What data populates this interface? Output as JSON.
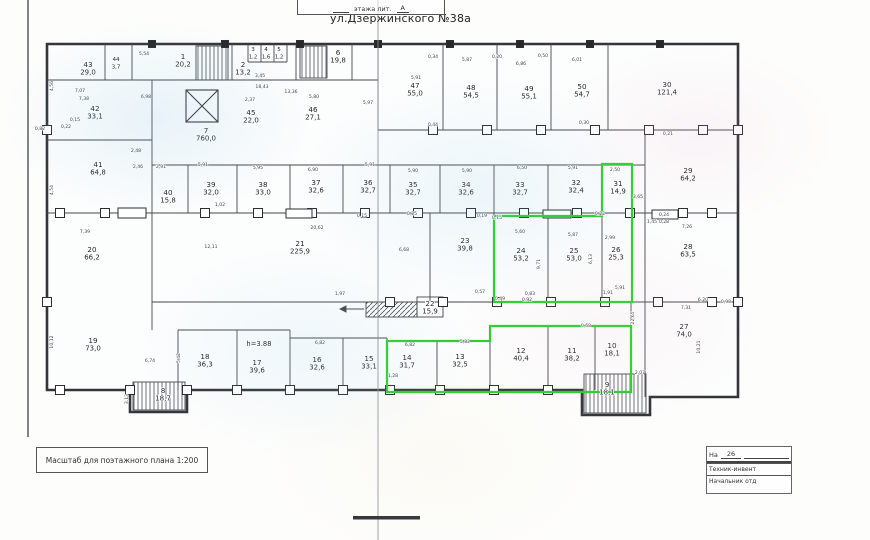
{
  "title": "ул.Дзержинского №38а",
  "stamp_top": {
    "text": "этажа лит.",
    "litera": "А"
  },
  "scale_note": "Масштаб для поэтажного плана 1:200",
  "stamp_bottom": {
    "na_label": "На",
    "na_value": "26",
    "row1": "Техник-инвент",
    "row2": "Начальник отд"
  },
  "colors": {
    "highlight": "#2ccf2c",
    "ink": "#23252a",
    "wall": "#33353a"
  },
  "plan": {
    "highlighted_rooms": [
      "10",
      "11",
      "12",
      "13",
      "14",
      "24",
      "25",
      "26",
      "31"
    ],
    "rooms": [
      {
        "n": "1",
        "a": "20,2",
        "x": 183,
        "y": 60
      },
      {
        "n": "2",
        "a": "13,2",
        "x": 243,
        "y": 68
      },
      {
        "n": "3",
        "a": "1,2",
        "x": 253,
        "y": 52,
        "s": 1
      },
      {
        "n": "4",
        "a": "1,6",
        "x": 266,
        "y": 52,
        "s": 1
      },
      {
        "n": "5",
        "a": "1,2",
        "x": 279,
        "y": 52,
        "s": 1
      },
      {
        "n": "6",
        "a": "19,8",
        "x": 338,
        "y": 56
      },
      {
        "n": "7",
        "a": "760,0",
        "x": 206,
        "y": 134
      },
      {
        "n": "8",
        "a": "18,7",
        "x": 163,
        "y": 394
      },
      {
        "n": "9",
        "a": "18,1",
        "x": 607,
        "y": 388
      },
      {
        "n": "10",
        "a": "18,1",
        "x": 612,
        "y": 349,
        "g": 1
      },
      {
        "n": "11",
        "a": "38,2",
        "x": 572,
        "y": 354,
        "g": 1
      },
      {
        "n": "12",
        "a": "40,4",
        "x": 521,
        "y": 354,
        "g": 1
      },
      {
        "n": "13",
        "a": "32,5",
        "x": 460,
        "y": 360,
        "g": 1
      },
      {
        "n": "14",
        "a": "31,7",
        "x": 407,
        "y": 361,
        "g": 1
      },
      {
        "n": "15",
        "a": "33,1",
        "x": 369,
        "y": 362
      },
      {
        "n": "16",
        "a": "32,6",
        "x": 317,
        "y": 363
      },
      {
        "n": "17",
        "a": "39,6",
        "x": 257,
        "y": 366
      },
      {
        "n": "18",
        "a": "36,3",
        "x": 205,
        "y": 360
      },
      {
        "n": "19",
        "a": "73,0",
        "x": 93,
        "y": 344
      },
      {
        "n": "20",
        "a": "66,2",
        "x": 92,
        "y": 253
      },
      {
        "n": "21",
        "a": "225,9",
        "x": 300,
        "y": 247
      },
      {
        "n": "22",
        "a": "15,9",
        "x": 430,
        "y": 307
      },
      {
        "n": "23",
        "a": "39,8",
        "x": 465,
        "y": 244
      },
      {
        "n": "24",
        "a": "53,2",
        "x": 521,
        "y": 254,
        "g": 1
      },
      {
        "n": "25",
        "a": "53,0",
        "x": 574,
        "y": 254,
        "g": 1
      },
      {
        "n": "26",
        "a": "25,3",
        "x": 616,
        "y": 253,
        "g": 1
      },
      {
        "n": "27",
        "a": "74,0",
        "x": 684,
        "y": 330
      },
      {
        "n": "28",
        "a": "63,5",
        "x": 688,
        "y": 250
      },
      {
        "n": "29",
        "a": "64,2",
        "x": 688,
        "y": 174
      },
      {
        "n": "30",
        "a": "121,4",
        "x": 667,
        "y": 88
      },
      {
        "n": "31",
        "a": "14,9",
        "x": 618,
        "y": 187,
        "g": 1
      },
      {
        "n": "32",
        "a": "32,4",
        "x": 576,
        "y": 186
      },
      {
        "n": "33",
        "a": "32,7",
        "x": 520,
        "y": 188
      },
      {
        "n": "34",
        "a": "32,6",
        "x": 466,
        "y": 188
      },
      {
        "n": "35",
        "a": "32,7",
        "x": 413,
        "y": 188
      },
      {
        "n": "36",
        "a": "32,7",
        "x": 368,
        "y": 186
      },
      {
        "n": "37",
        "a": "32,6",
        "x": 316,
        "y": 186
      },
      {
        "n": "38",
        "a": "33,0",
        "x": 263,
        "y": 188
      },
      {
        "n": "39",
        "a": "32,0",
        "x": 211,
        "y": 188
      },
      {
        "n": "40",
        "a": "15,8",
        "x": 168,
        "y": 196
      },
      {
        "n": "41",
        "a": "64,8",
        "x": 98,
        "y": 168
      },
      {
        "n": "42",
        "a": "33,1",
        "x": 95,
        "y": 112
      },
      {
        "n": "43",
        "a": "29,0",
        "x": 88,
        "y": 68
      },
      {
        "n": "44",
        "a": "3,7",
        "x": 116,
        "y": 62,
        "s": 1
      },
      {
        "n": "45",
        "a": "22,0",
        "x": 251,
        "y": 116
      },
      {
        "n": "46",
        "a": "27,1",
        "x": 313,
        "y": 113
      },
      {
        "n": "47",
        "a": "55,0",
        "x": 415,
        "y": 89
      },
      {
        "n": "48",
        "a": "54,5",
        "x": 471,
        "y": 91
      },
      {
        "n": "49",
        "a": "55,1",
        "x": 529,
        "y": 92
      },
      {
        "n": "50",
        "a": "54,7",
        "x": 582,
        "y": 90
      }
    ],
    "annotations": [
      {
        "t": "h=3.88",
        "x": 259,
        "y": 346
      }
    ],
    "dimensions": [
      {
        "t": "7,07",
        "x": 80,
        "y": 92
      },
      {
        "t": "7,38",
        "x": 84,
        "y": 100
      },
      {
        "t": "0,82",
        "x": 40,
        "y": 130
      },
      {
        "t": "0,22",
        "x": 66,
        "y": 128
      },
      {
        "t": "0,15",
        "x": 75,
        "y": 121
      },
      {
        "t": "6,98",
        "x": 146,
        "y": 98
      },
      {
        "t": "5,54",
        "x": 144,
        "y": 55
      },
      {
        "t": "7,39",
        "x": 85,
        "y": 233
      },
      {
        "t": "4,56",
        "x": 53,
        "y": 86,
        "r": 1
      },
      {
        "t": "4,54",
        "x": 53,
        "y": 190,
        "r": 1
      },
      {
        "t": "10,12",
        "x": 53,
        "y": 342,
        "r": 1
      },
      {
        "t": "3,45",
        "x": 260,
        "y": 77
      },
      {
        "t": "18,43",
        "x": 262,
        "y": 88
      },
      {
        "t": "13,36",
        "x": 291,
        "y": 93
      },
      {
        "t": "5,80",
        "x": 314,
        "y": 98
      },
      {
        "t": "2,37",
        "x": 250,
        "y": 101
      },
      {
        "t": "5,97",
        "x": 368,
        "y": 104
      },
      {
        "t": "5,87",
        "x": 467,
        "y": 61
      },
      {
        "t": "6,86",
        "x": 521,
        "y": 65
      },
      {
        "t": "6,01",
        "x": 577,
        "y": 61
      },
      {
        "t": "5,91",
        "x": 416,
        "y": 79
      },
      {
        "t": "0,34",
        "x": 433,
        "y": 58
      },
      {
        "t": "0,20",
        "x": 497,
        "y": 58
      },
      {
        "t": "0,50",
        "x": 543,
        "y": 57
      },
      {
        "t": "0,44",
        "x": 433,
        "y": 126
      },
      {
        "t": "0,30",
        "x": 584,
        "y": 124
      },
      {
        "t": "0,21",
        "x": 668,
        "y": 135
      },
      {
        "t": "2,46",
        "x": 138,
        "y": 168
      },
      {
        "t": "2,91",
        "x": 161,
        "y": 168
      },
      {
        "t": "5,91",
        "x": 203,
        "y": 166
      },
      {
        "t": "5,95",
        "x": 258,
        "y": 169
      },
      {
        "t": "6,90",
        "x": 313,
        "y": 171
      },
      {
        "t": "5,91",
        "x": 370,
        "y": 166
      },
      {
        "t": "5,90",
        "x": 413,
        "y": 172
      },
      {
        "t": "5,90",
        "x": 467,
        "y": 172
      },
      {
        "t": "6,50",
        "x": 522,
        "y": 169
      },
      {
        "t": "5,91",
        "x": 573,
        "y": 169
      },
      {
        "t": "2,50",
        "x": 615,
        "y": 171
      },
      {
        "t": "3,65",
        "x": 638,
        "y": 198
      },
      {
        "t": "7,26",
        "x": 687,
        "y": 228
      },
      {
        "t": "1,02",
        "x": 220,
        "y": 206
      },
      {
        "t": "0,15",
        "x": 362,
        "y": 217
      },
      {
        "t": "0,25",
        "x": 412,
        "y": 215
      },
      {
        "t": "0,19",
        "x": 482,
        "y": 217
      },
      {
        "t": "0,15",
        "x": 497,
        "y": 219
      },
      {
        "t": "0,22",
        "x": 600,
        "y": 215
      },
      {
        "t": "0,24",
        "x": 664,
        "y": 216
      },
      {
        "t": "0,28",
        "x": 664,
        "y": 223
      },
      {
        "t": "1,45",
        "x": 652,
        "y": 223
      },
      {
        "t": "20,62",
        "x": 317,
        "y": 229
      },
      {
        "t": "12,11",
        "x": 211,
        "y": 248
      },
      {
        "t": "6,68",
        "x": 404,
        "y": 251
      },
      {
        "t": "5,60",
        "x": 520,
        "y": 233
      },
      {
        "t": "5,87",
        "x": 573,
        "y": 236
      },
      {
        "t": "2,99",
        "x": 610,
        "y": 239
      },
      {
        "t": "9,71",
        "x": 540,
        "y": 264,
        "r": 1
      },
      {
        "t": "6,13",
        "x": 592,
        "y": 259,
        "r": 1
      },
      {
        "t": "1,91",
        "x": 608,
        "y": 294
      },
      {
        "t": "5,91",
        "x": 620,
        "y": 289
      },
      {
        "t": "22,65",
        "x": 634,
        "y": 318,
        "r": 1
      },
      {
        "t": "7,31",
        "x": 686,
        "y": 309
      },
      {
        "t": "10,21",
        "x": 700,
        "y": 347,
        "r": 1
      },
      {
        "t": "2,07",
        "x": 640,
        "y": 374
      },
      {
        "t": "6,20",
        "x": 703,
        "y": 301
      },
      {
        "t": "0,98",
        "x": 726,
        "y": 303
      },
      {
        "t": "5,42",
        "x": 180,
        "y": 358,
        "r": 1
      },
      {
        "t": "6,74",
        "x": 150,
        "y": 362
      },
      {
        "t": "6,82",
        "x": 320,
        "y": 344
      },
      {
        "t": "6,82",
        "x": 410,
        "y": 346
      },
      {
        "t": "5,82",
        "x": 465,
        "y": 343
      },
      {
        "t": "1,28",
        "x": 393,
        "y": 377
      },
      {
        "t": "0,49",
        "x": 500,
        "y": 300
      },
      {
        "t": "0,92",
        "x": 527,
        "y": 301
      },
      {
        "t": "0,68",
        "x": 586,
        "y": 327
      },
      {
        "t": "2,48",
        "x": 136,
        "y": 152
      },
      {
        "t": "3,13",
        "x": 128,
        "y": 399,
        "r": 1
      },
      {
        "t": "1,97",
        "x": 340,
        "y": 295
      },
      {
        "t": "0,57",
        "x": 480,
        "y": 293
      },
      {
        "t": "0,83",
        "x": 530,
        "y": 295
      }
    ]
  }
}
